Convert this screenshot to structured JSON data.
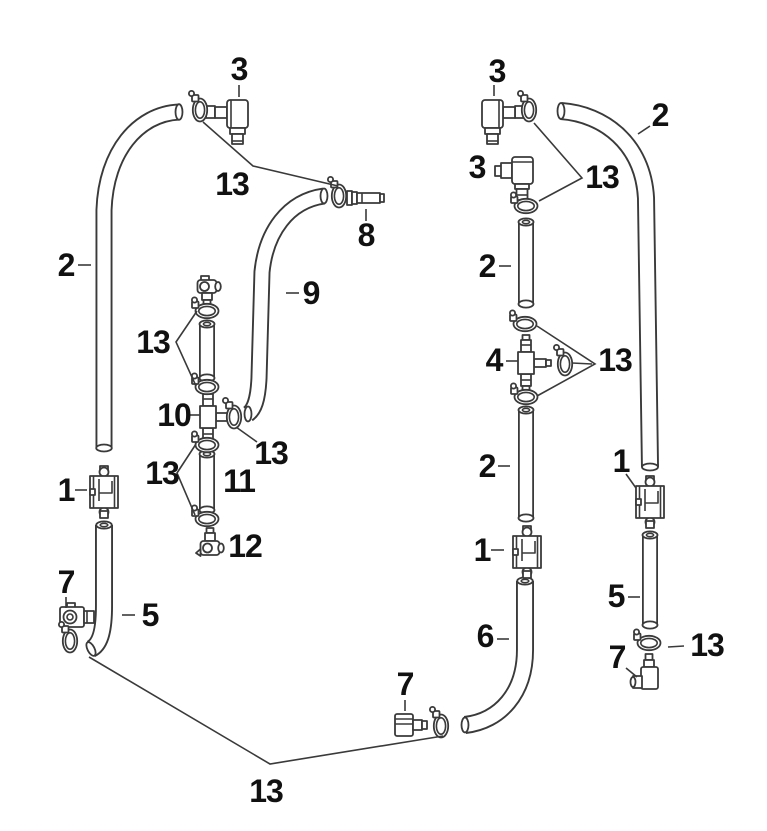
{
  "diagram": {
    "type": "exploded-parts-diagram",
    "subject": "hose, clamp and connector assembly",
    "colors": {
      "background": "#ffffff",
      "line": "#3a3a3a",
      "label": "#111111"
    },
    "part_numbers_visible": [
      "1",
      "2",
      "3",
      "4",
      "5",
      "6",
      "7",
      "8",
      "9",
      "10",
      "11",
      "12",
      "13"
    ],
    "callouts": [
      {
        "part": "3",
        "x": 239,
        "y": 69,
        "leaders": [
          [
            [
              239,
              85
            ],
            [
              239,
              97
            ]
          ]
        ]
      },
      {
        "part": "13",
        "x": 232,
        "y": 184,
        "leaders": [
          [
            [
              203,
              122
            ],
            [
              253,
              166
            ],
            [
              338,
              186
            ]
          ]
        ]
      },
      {
        "part": "8",
        "x": 366,
        "y": 235,
        "leaders": [
          [
            [
              366,
              209
            ],
            [
              366,
              221
            ]
          ]
        ]
      },
      {
        "part": "2",
        "x": 66,
        "y": 265,
        "leaders": [
          [
            [
              78,
              265
            ],
            [
              91,
              265
            ]
          ]
        ]
      },
      {
        "part": "9",
        "x": 311,
        "y": 293,
        "leaders": [
          [
            [
              286,
              293
            ],
            [
              299,
              293
            ]
          ]
        ]
      },
      {
        "part": "13",
        "x": 153,
        "y": 342,
        "leaders": [
          [
            [
              197,
              311
            ],
            [
              176,
              342
            ],
            [
              196,
              386
            ]
          ]
        ]
      },
      {
        "part": "10",
        "x": 174,
        "y": 415,
        "leaders": [
          [
            [
              188,
              415
            ],
            [
              200,
              415
            ]
          ]
        ]
      },
      {
        "part": "13",
        "x": 271,
        "y": 453,
        "leaders": [
          [
            [
              236,
              427
            ],
            [
              257,
              442
            ]
          ]
        ]
      },
      {
        "part": "13",
        "x": 162,
        "y": 473,
        "leaders": [
          [
            [
              196,
              444
            ],
            [
              177,
              473
            ],
            [
              195,
              515
            ]
          ]
        ]
      },
      {
        "part": "11",
        "x": 239,
        "y": 481,
        "leaders": []
      },
      {
        "part": "1",
        "x": 66,
        "y": 490,
        "leaders": [
          [
            [
              75,
              490
            ],
            [
              87,
              490
            ]
          ]
        ]
      },
      {
        "part": "12",
        "x": 245,
        "y": 546,
        "leaders": []
      },
      {
        "part": "7",
        "x": 66,
        "y": 582,
        "leaders": [
          [
            [
              66,
              597
            ],
            [
              66,
              608
            ]
          ]
        ]
      },
      {
        "part": "5",
        "x": 150,
        "y": 615,
        "leaders": [
          [
            [
              122,
              615
            ],
            [
              135,
              615
            ]
          ]
        ]
      },
      {
        "part": "3",
        "x": 497,
        "y": 71,
        "leaders": [
          [
            [
              494,
              85
            ],
            [
              494,
              96
            ]
          ]
        ]
      },
      {
        "part": "3",
        "x": 477,
        "y": 167,
        "leaders": []
      },
      {
        "part": "13",
        "x": 602,
        "y": 177,
        "leaders": [
          [
            [
              534,
              123
            ],
            [
              582,
              178
            ],
            [
              539,
              201
            ]
          ]
        ]
      },
      {
        "part": "2",
        "x": 660,
        "y": 115,
        "leaders": [
          [
            [
              650,
              126
            ],
            [
              638,
              134
            ]
          ]
        ]
      },
      {
        "part": "2",
        "x": 487,
        "y": 266,
        "leaders": [
          [
            [
              499,
              266
            ],
            [
              511,
              266
            ]
          ]
        ]
      },
      {
        "part": "4",
        "x": 494,
        "y": 360,
        "leaders": [
          [
            [
              506,
              361
            ],
            [
              518,
              361
            ]
          ]
        ]
      },
      {
        "part": "13",
        "x": 615,
        "y": 360,
        "leaders": [
          [
            [
              537,
              326
            ],
            [
              595,
              364
            ],
            [
              537,
              396
            ]
          ],
          [
            [
              572,
              363
            ],
            [
              592,
              364
            ]
          ]
        ]
      },
      {
        "part": "2",
        "x": 487,
        "y": 466,
        "leaders": [
          [
            [
              498,
              466
            ],
            [
              510,
              466
            ]
          ]
        ]
      },
      {
        "part": "1",
        "x": 621,
        "y": 461,
        "leaders": [
          [
            [
              626,
              474
            ],
            [
              636,
              488
            ]
          ]
        ]
      },
      {
        "part": "1",
        "x": 482,
        "y": 550,
        "leaders": [
          [
            [
              491,
              550
            ],
            [
              504,
              550
            ]
          ]
        ]
      },
      {
        "part": "5",
        "x": 616,
        "y": 596,
        "leaders": [
          [
            [
              628,
              597
            ],
            [
              640,
              597
            ]
          ]
        ]
      },
      {
        "part": "6",
        "x": 485,
        "y": 636,
        "leaders": [
          [
            [
              497,
              639
            ],
            [
              509,
              639
            ]
          ]
        ]
      },
      {
        "part": "13",
        "x": 707,
        "y": 645,
        "leaders": [
          [
            [
              668,
              647
            ],
            [
              684,
              646
            ]
          ]
        ]
      },
      {
        "part": "7",
        "x": 617,
        "y": 657,
        "leaders": [
          [
            [
              626,
              668
            ],
            [
              637,
              677
            ]
          ]
        ]
      },
      {
        "part": "7",
        "x": 405,
        "y": 684,
        "leaders": [
          [
            [
              405,
              700
            ],
            [
              405,
              711
            ]
          ]
        ]
      },
      {
        "part": "13",
        "x": 266,
        "y": 791,
        "leaders": [
          [
            [
              89,
              657
            ],
            [
              270,
              764
            ],
            [
              443,
              736
            ]
          ]
        ]
      }
    ]
  }
}
